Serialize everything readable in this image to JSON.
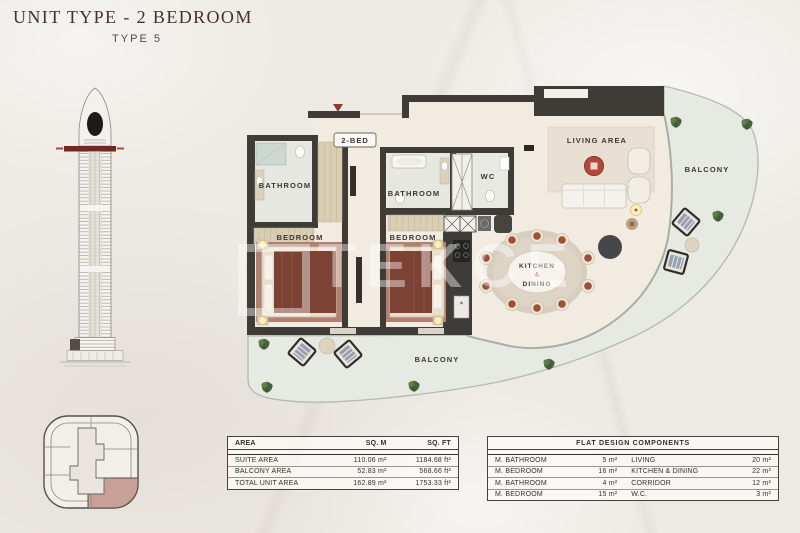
{
  "header": {
    "title": "UNIT TYPE - 2 BEDROOM",
    "subtitle": "TYPE 5"
  },
  "watermark": {
    "brand": "TEKCE"
  },
  "floor_plan": {
    "badge": "2-BED",
    "labels": {
      "bathroom_left": "BATHROOM",
      "bathroom_middle": "BATHROOM",
      "bedroom_left": "BEDROOM",
      "bedroom_middle": "BEDROOM",
      "wc": "WC",
      "living_area": "LIVING AREA",
      "kitchen": "KITCHEN",
      "kitchen_dining_separator": "&",
      "dining": "DINING",
      "balcony_right": "BALCONY",
      "balcony_bottom": "BALCONY"
    }
  },
  "area_table": {
    "headers": [
      "AREA",
      "SQ. M",
      "SQ. FT"
    ],
    "rows": [
      {
        "label": "SUITE AREA",
        "sqm": "110.06 m²",
        "sqft": "1184.68 ft²"
      },
      {
        "label": "BALCONY AREA",
        "sqm": "52.83 m²",
        "sqft": "568.66 ft²"
      },
      {
        "label": "TOTAL UNIT AREA",
        "sqm": "162.89 m²",
        "sqft": "1753.33 ft²"
      }
    ]
  },
  "components_table": {
    "title": "FLAT DESIGN COMPONENTS",
    "rows": [
      {
        "label_left": "M. BATHROOM",
        "value_left": "5 m²",
        "label_right": "LIVING",
        "value_right": "20 m²"
      },
      {
        "label_left": "M. BEDROOM",
        "value_left": "16 m²",
        "label_right": "KITCHEN & DINING",
        "value_right": "22 m²"
      },
      {
        "label_left": "M. BATHROOM",
        "value_left": "4 m²",
        "label_right": "CORRIDOR",
        "value_right": "12 m²"
      },
      {
        "label_left": "M. BEDROOM",
        "value_left": "15 m²",
        "label_right": "W.C.",
        "value_right": "3 m²"
      }
    ]
  },
  "colors": {
    "wall": "#3f3c38",
    "accent_red": "#b3483a",
    "interior_floor": "#f1ebe1",
    "balcony_floor": "#e7eae3",
    "keyplan_highlight": "#c8a097",
    "tower_level_band": "#6f2b1f"
  }
}
